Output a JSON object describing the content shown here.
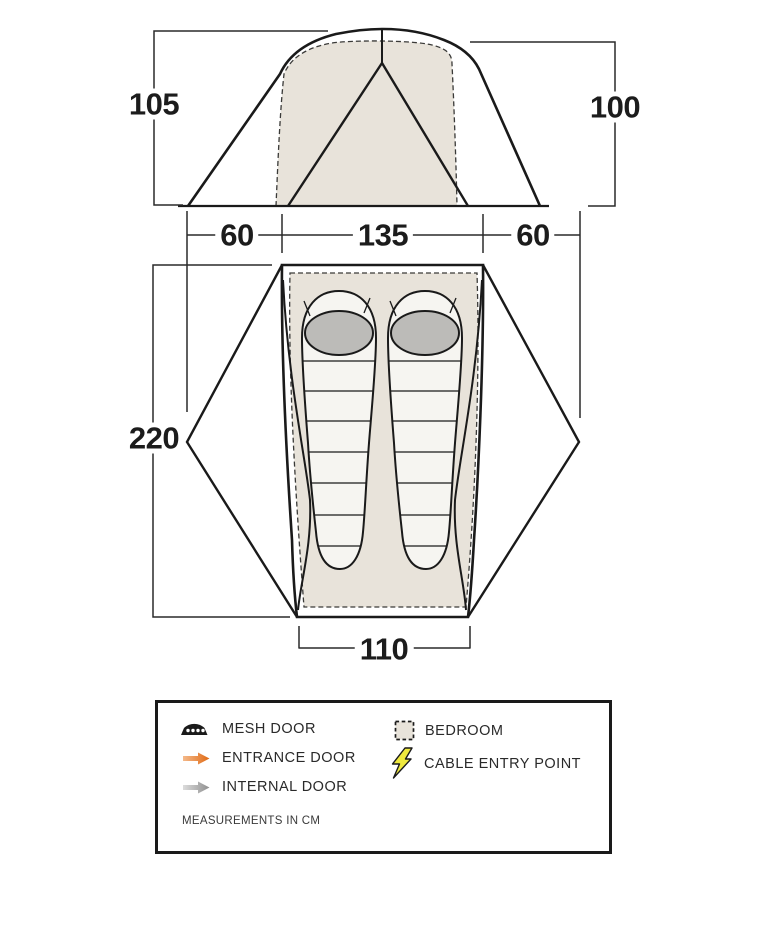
{
  "diagram_name": "Tent dimensions diagram",
  "dimensions": {
    "height_left": "105",
    "height_right": "100",
    "width_left": "60",
    "width_center": "135",
    "width_right": "60",
    "length": "220",
    "door_width": "110"
  },
  "legend": {
    "items": [
      {
        "icon": "mesh-door-icon",
        "label": "MESH DOOR"
      },
      {
        "icon": "entrance-door-icon",
        "label": "ENTRANCE DOOR"
      },
      {
        "icon": "internal-door-icon",
        "label": "INTERNAL DOOR"
      },
      {
        "icon": "bedroom-icon",
        "label": "BEDROOM"
      },
      {
        "icon": "cable-entry-point-icon",
        "label": "CABLE ENTRY POINT"
      }
    ],
    "note": "MEASUREMENTS IN CM"
  },
  "colors": {
    "line": "#1a1a1a",
    "bedroom_fill": "#e8e3da",
    "sleeping_bag_fill": "#f6f5f1",
    "sleeping_bag_hood": "#bcbbb8",
    "entrance_arrow": "#e87220",
    "entrance_arrow_light": "#f4b98a",
    "internal_arrow": "#8f8f8f",
    "internal_arrow_light": "#d9d9d9",
    "cable_bolt": "#efe93d"
  }
}
